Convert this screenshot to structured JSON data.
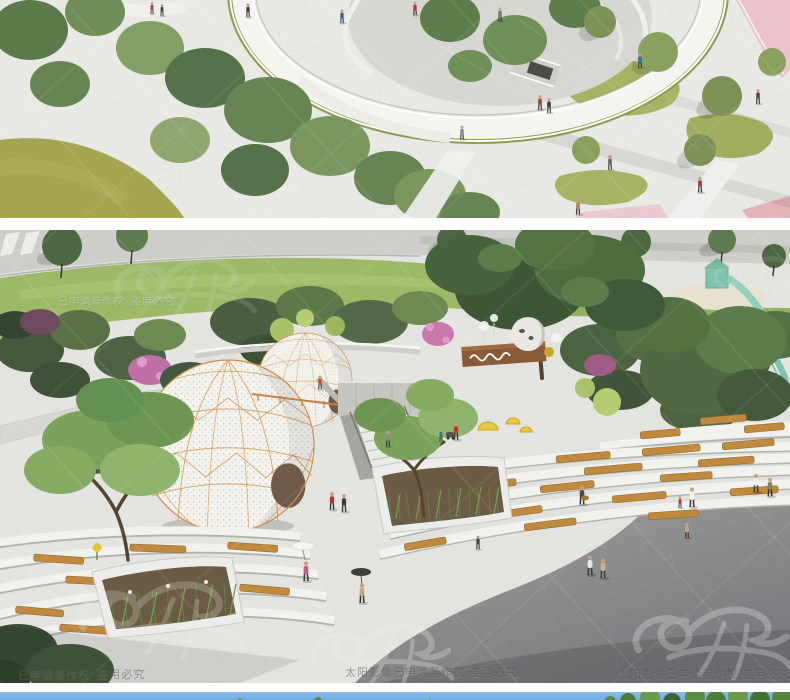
{
  "gallery": {
    "sections": [
      {
        "id": "render-1",
        "label": "aerial park loop rendering"
      },
      {
        "id": "render-2",
        "label": "sunken plaza with dome pavilions rendering"
      },
      {
        "id": "render-3",
        "label": "next rendering top edge (sky and foliage)"
      }
    ]
  },
  "watermark": {
    "logo": "calligraphy-runner-logo",
    "text_short": "'已申请著作权' 盗用必究",
    "text_long": "太阳影像已申请著作权 盗用必究"
  },
  "colors": {
    "page_background": "#ffffff",
    "sky_blue": "#7fb5e9",
    "lawn_olive": "#a6a752",
    "grass_green": "#9db968",
    "foliage_dark": "#46593d",
    "foliage_mid": "#6d8a52",
    "dome_panel_white": "#f5f3ee",
    "dome_frame_orange": "#c8813d",
    "bench_wood": "#bf8a3e",
    "jogging_track_pink": "#ecc3c9",
    "pavement_light": "#e4e4e1",
    "pavement_dark": "#8f9092",
    "slide_teal": "#7fc3ae"
  }
}
